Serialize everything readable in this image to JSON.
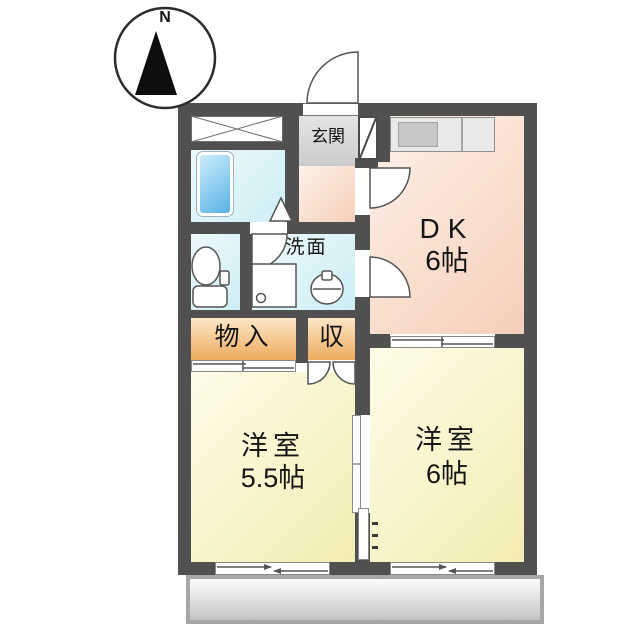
{
  "compass": {
    "north_label": "N"
  },
  "rooms": {
    "entrance": {
      "label": "玄関"
    },
    "dk": {
      "label": "DK",
      "size": "6帖"
    },
    "washroom": {
      "label": "洗面"
    },
    "storage": {
      "label": "物入"
    },
    "closet": {
      "label": "収"
    },
    "bedroom_small": {
      "label": "洋室",
      "size": "5.5帖"
    },
    "bedroom_large": {
      "label": "洋室",
      "size": "6帖"
    }
  },
  "fixtures": {
    "bathtub": "bathtub",
    "toilet": "toilet",
    "washing_machine_pan": "washing-machine-pan",
    "washbasin": "washbasin",
    "kitchen_counter": "kitchen-counter",
    "shoe_cabinet": "shoe-cabinet",
    "balcony": "balcony"
  },
  "colors": {
    "wall": "#505050",
    "dk_floor": "#f6cfb9",
    "bedroom_floor": "#f3edb2",
    "water_floor": "#cdeef5",
    "closet_floor": "#edab5e",
    "entrance_floor": "#d6d6d6",
    "bathtub": "#58b1e7",
    "balcony": "#c4c4c4"
  }
}
